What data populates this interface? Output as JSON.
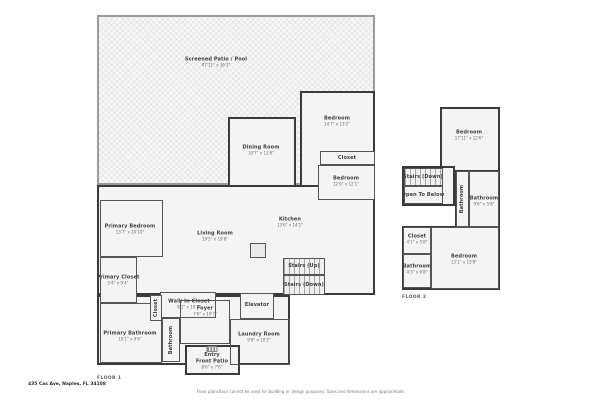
{
  "colors": {
    "wall": "#3a3a3a",
    "screen_wall": "#9b9b9b",
    "room_fill": "#f4f4f4",
    "label_text": "#3f3f3f",
    "dim_text": "#6e6e6e"
  },
  "footer": {
    "address": "435 Cas Ave, Naples, FL 34108",
    "disclaimer": "Floor plans/tour cannot be used for building or design purposes. Sizes and dimensions are approximate."
  },
  "floor1": {
    "label": "FLOOR 1",
    "screened_patio": {
      "name": "Screened Patio / Pool",
      "dims": "47'11\" x 36'3\""
    },
    "bedroom1": {
      "name": "Bedroom",
      "dims": "14'7\" x 13'2\""
    },
    "closet1": {
      "name": "Closet"
    },
    "bedroom2": {
      "name": "Bedroom",
      "dims": "12'6\" x 12'1\""
    },
    "dining_room": {
      "name": "Dining Room",
      "dims": "10'7\" x 13'6\""
    },
    "living_room": {
      "name": "Living Room",
      "dims": "19'5\" x 19'8\""
    },
    "kitchen": {
      "name": "Kitchen",
      "dims": "13'6\" x 14'1\""
    },
    "primary_bedroom": {
      "name": "Primary Bedroom",
      "dims": "13'7\" x 20'10\""
    },
    "primary_closet": {
      "name": "Primary Closet",
      "dims": "5'4\" x 9'4\""
    },
    "primary_bathroom": {
      "name": "Primary Bathroom",
      "dims": "10'1\" x 9'6\""
    },
    "walk_in_closet": {
      "name": "Walk In Closet",
      "dims": "8'1\" x 10'7\""
    },
    "closet2": {
      "name": "Closet"
    },
    "bathroom": {
      "name": "Bathroom"
    },
    "foyer": {
      "name": "Foyer",
      "dims": "7'6\" x 10'7\""
    },
    "elevator": {
      "name": "Elevator"
    },
    "laundry_room": {
      "name": "Laundry Room",
      "dims": "9'6\" x 10'2\""
    },
    "stairs_up": {
      "name": "Stairs (Up)"
    },
    "stairs_down": {
      "name": "Stairs (Down)"
    },
    "entry": {
      "name": "Entry"
    },
    "front_patio": {
      "name": "Front Patio",
      "dims": "8'6\" x 7'6\""
    }
  },
  "floor2": {
    "label": "FLOOR 2",
    "bedroom_top": {
      "name": "Bedroom",
      "dims": "17'11\" x 12'6\""
    },
    "stairs_down": {
      "name": "Stairs (Down)"
    },
    "open_to_below": {
      "name": "Open To Below"
    },
    "bathroom_small": {
      "name": "Bathroom"
    },
    "bathroom_right": {
      "name": "Bathroom",
      "dims": "9'6\" x 5'8\""
    },
    "closet": {
      "name": "Closet",
      "dims": "4'1\" x 5'8\""
    },
    "bathroom_left": {
      "name": "Bathroom",
      "dims": "4'3\" x 6'8\""
    },
    "bedroom_bottom": {
      "name": "Bedroom",
      "dims": "13'1\" x 13'8\""
    }
  }
}
